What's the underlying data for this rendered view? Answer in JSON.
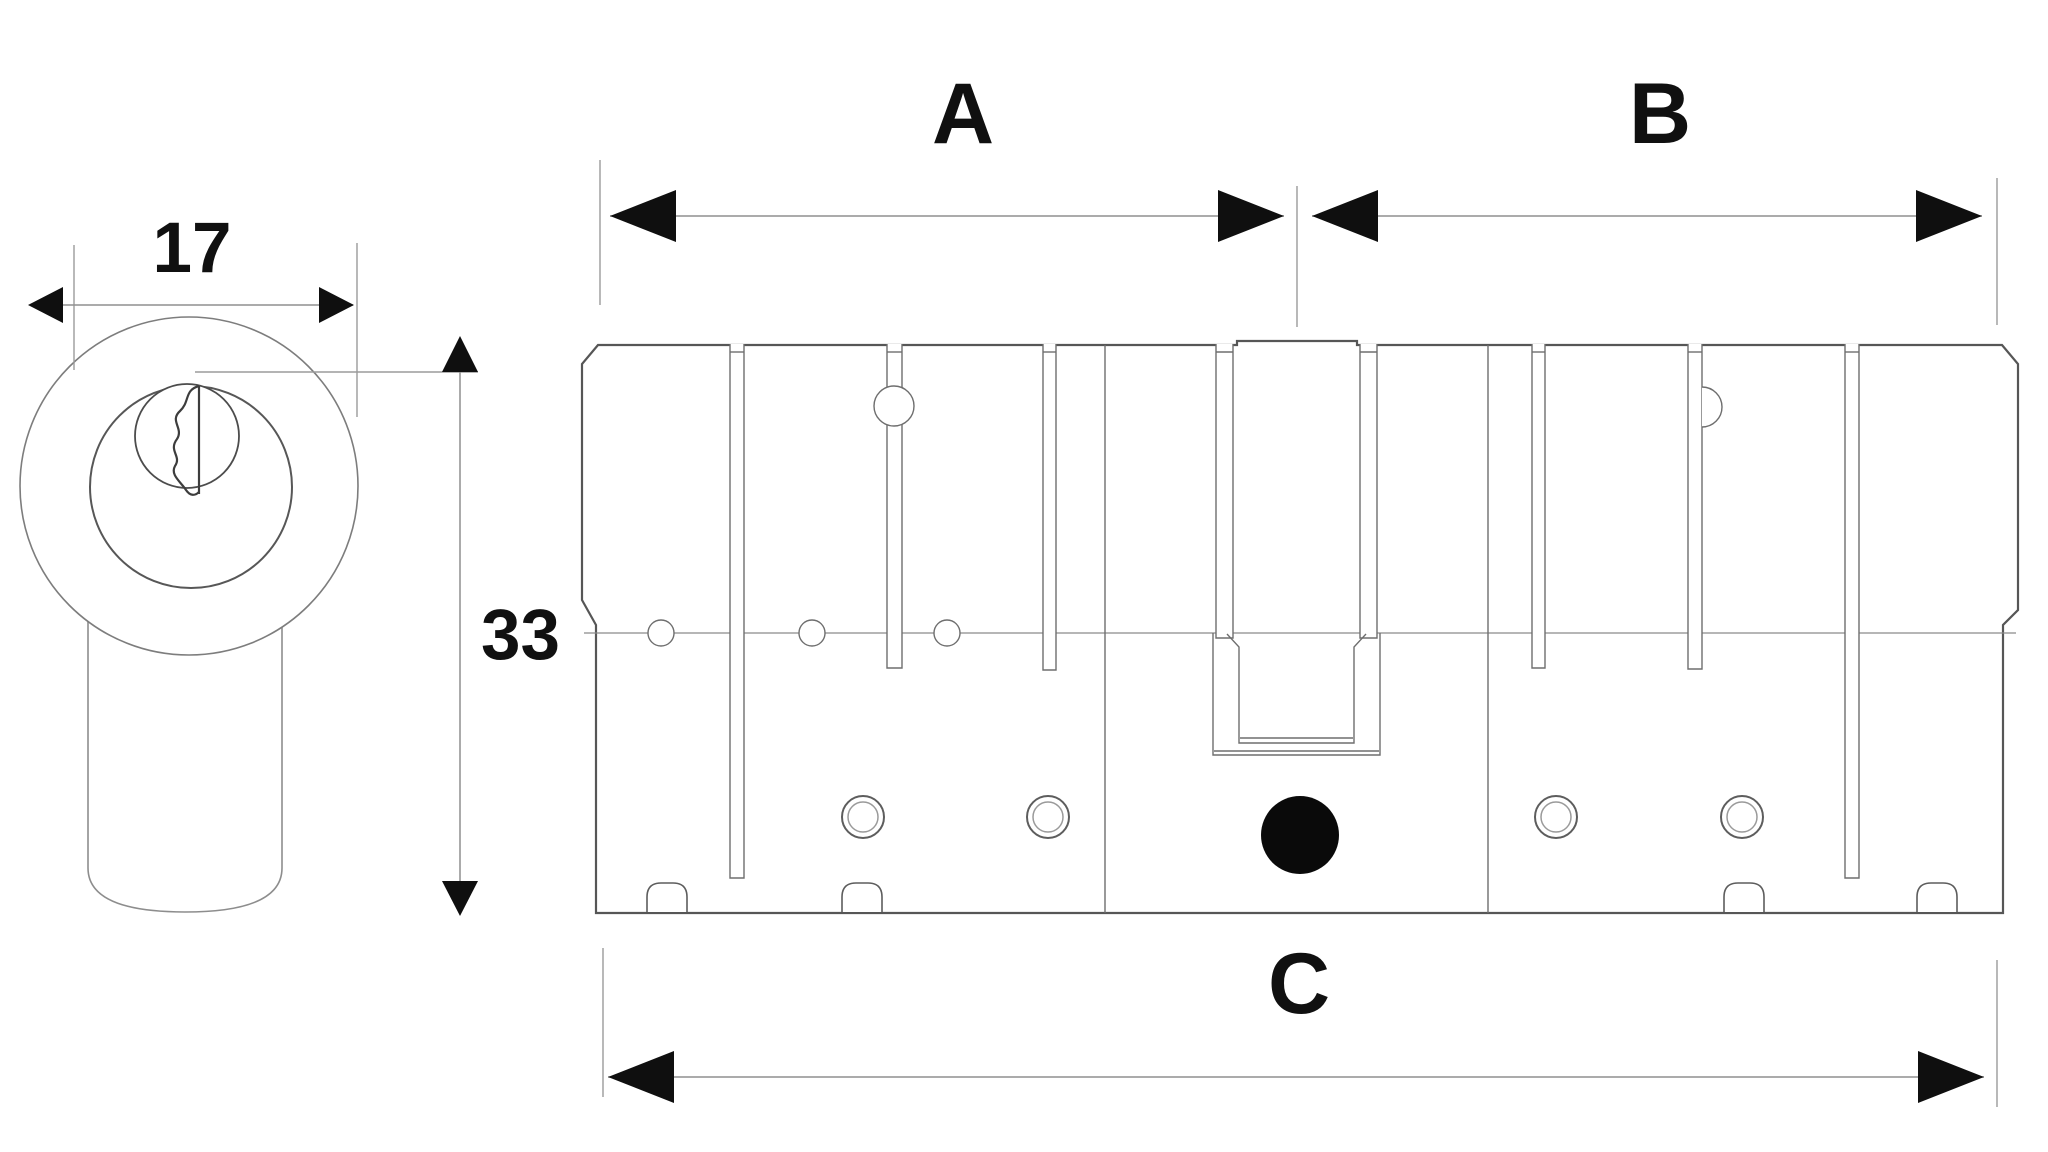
{
  "labels": {
    "plug_diameter": "17",
    "body_height": "33",
    "side_a": "A",
    "side_b": "B",
    "total_length": "C"
  },
  "colors": {
    "background": "#ffffff",
    "outline": "#565656",
    "detail_line": "#6e6e6e",
    "dimension_line": "#8f8f8f",
    "arrow": "#0f0f0f",
    "text": "#101010",
    "cam_dot": "#0a0a0a"
  }
}
